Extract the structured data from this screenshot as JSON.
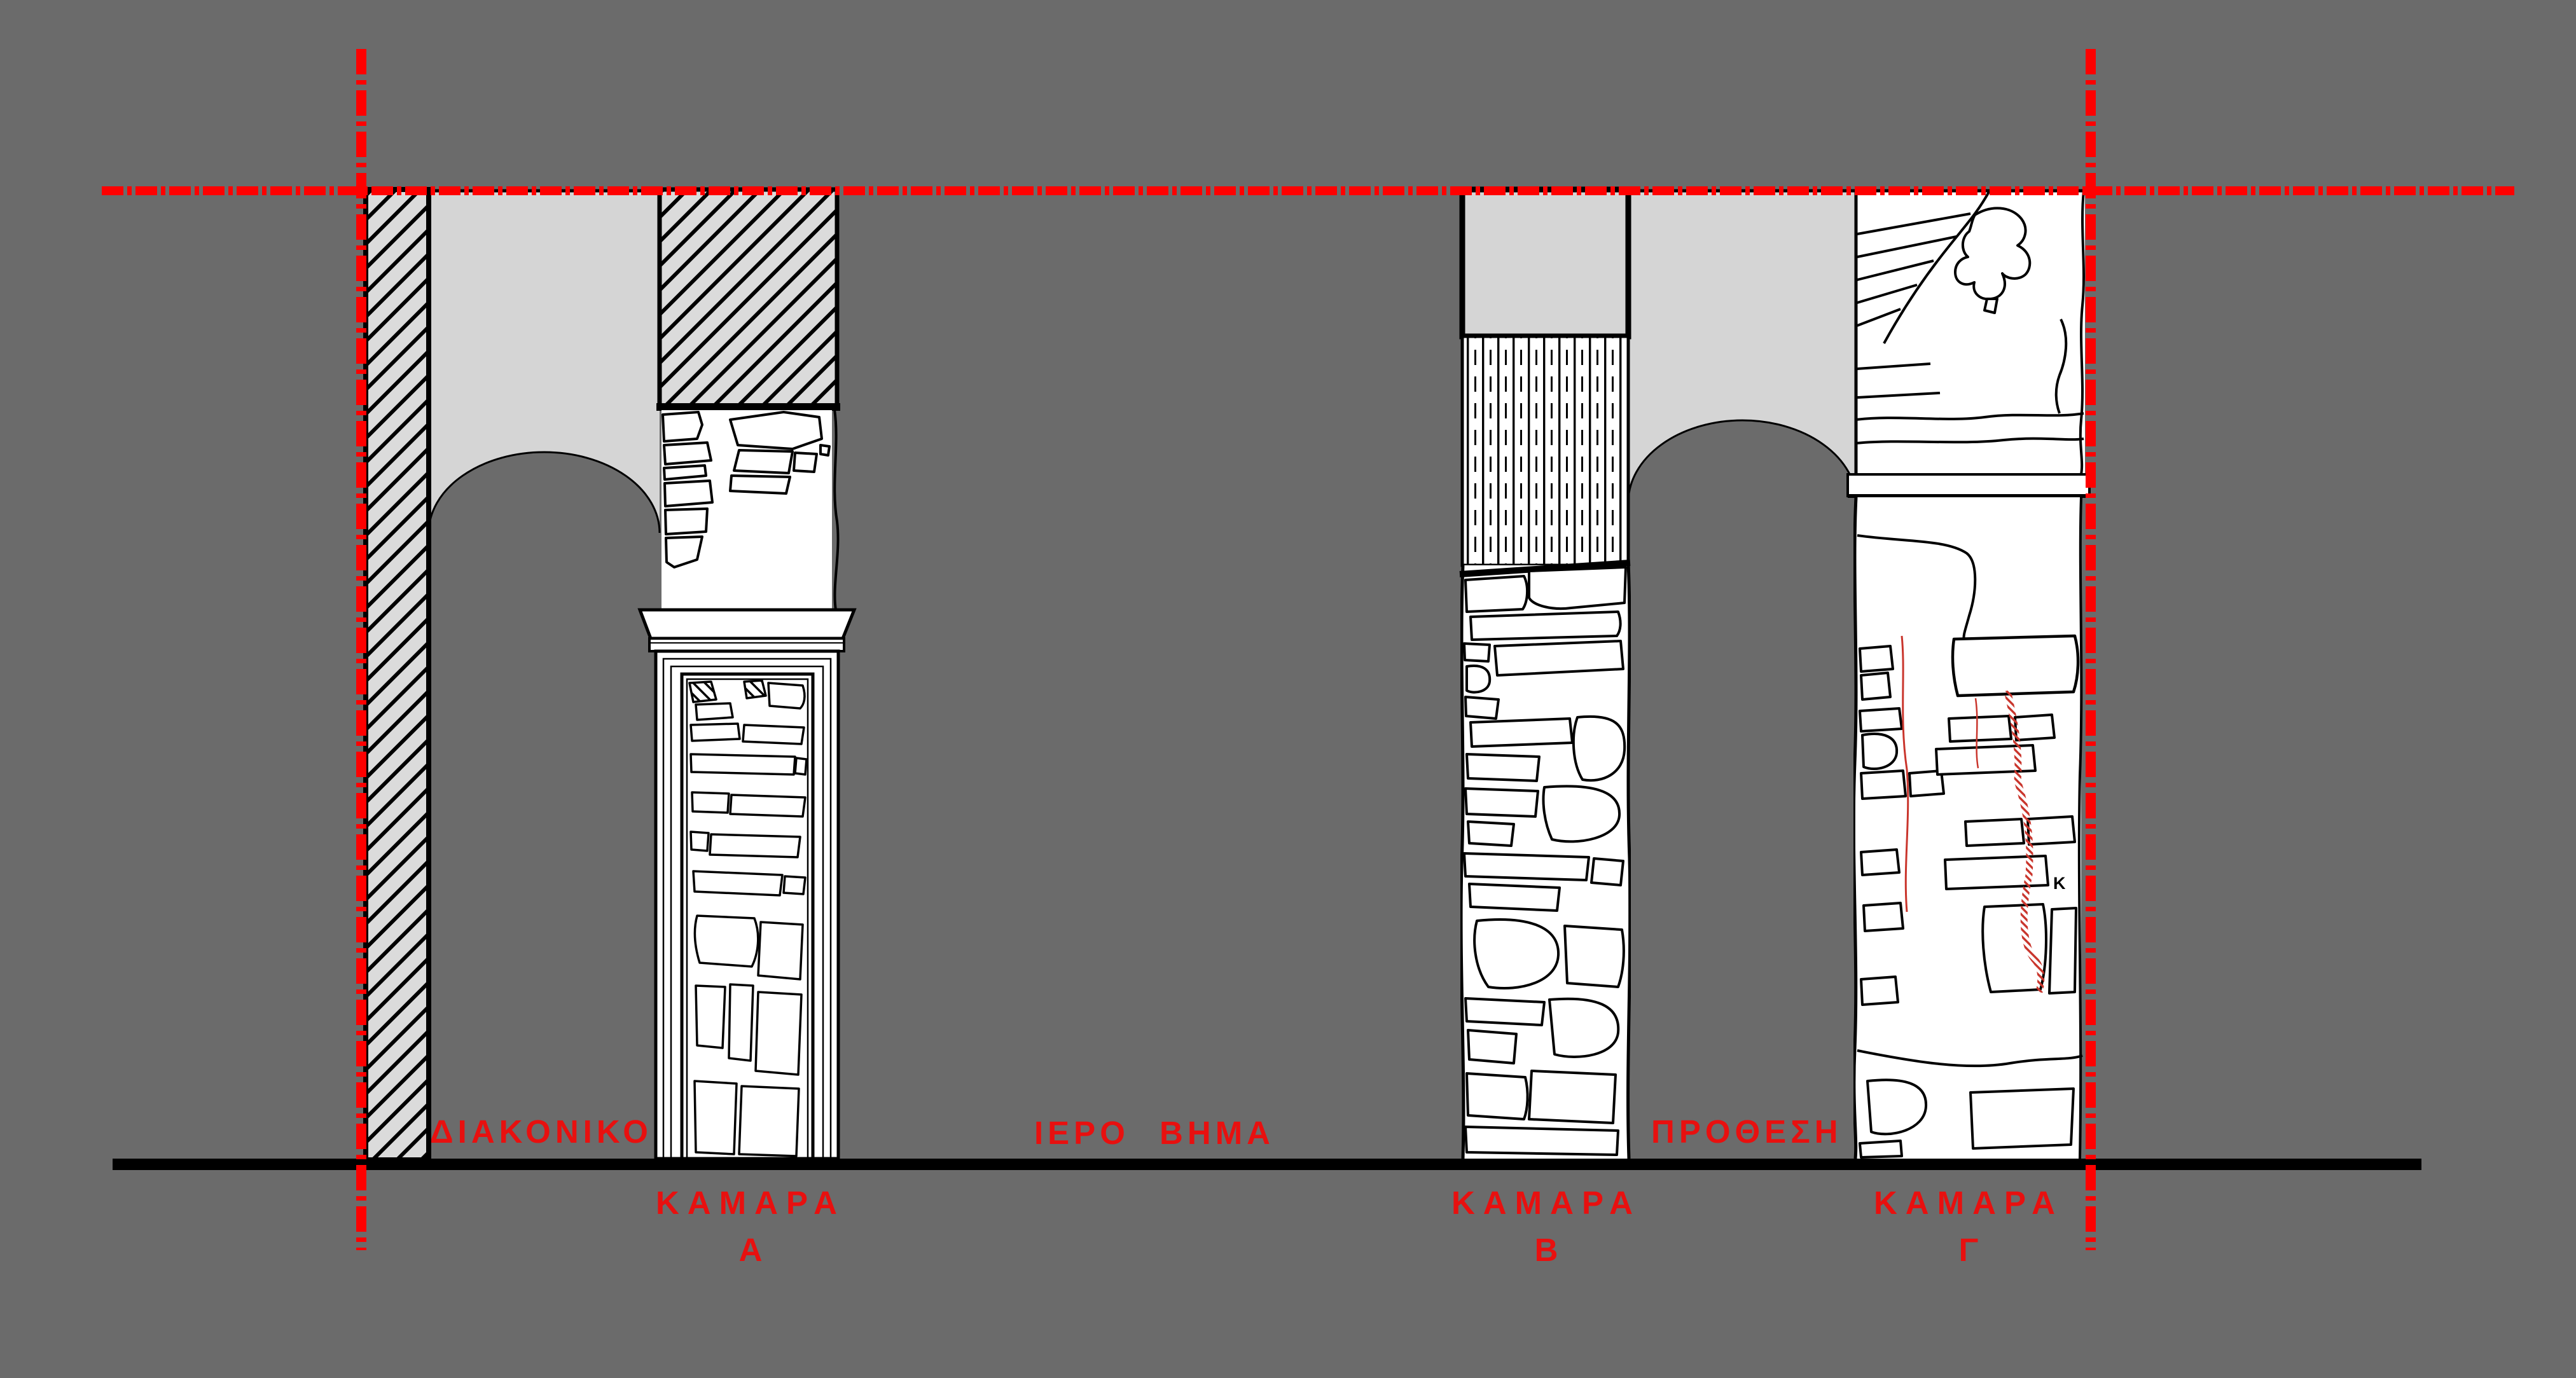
{
  "drawing": {
    "type": "architectural-section-elevation",
    "colors": {
      "background": "#6b6b6b",
      "wall_plaster": "#d5d5d5",
      "hatch_fill": "#dbdbdb",
      "stone_fill": "#ffffff",
      "ink": "#000000",
      "section_grid_red": "#fe0000",
      "label_red": "#e8100f",
      "crack_red": "#c9352c"
    },
    "room_labels": [
      {
        "id": "diakoniko",
        "text": "ΔΙΑΚΟΝΙΚΟ"
      },
      {
        "id": "iero_vima",
        "text": "ΙΕΡΟ ΒΗΜΑ"
      },
      {
        "id": "prothesi",
        "text": "ΠΡΟΘΕΣΗ"
      }
    ],
    "vault_labels": [
      {
        "word": "ΚΑΜΑΡΑ",
        "letter": "Α"
      },
      {
        "word": "ΚΑΜΑΡΑ",
        "letter": "Β"
      },
      {
        "word": "ΚΑΜΑΡΑ",
        "letter": "Γ"
      }
    ],
    "stone_mark": "Κ"
  }
}
